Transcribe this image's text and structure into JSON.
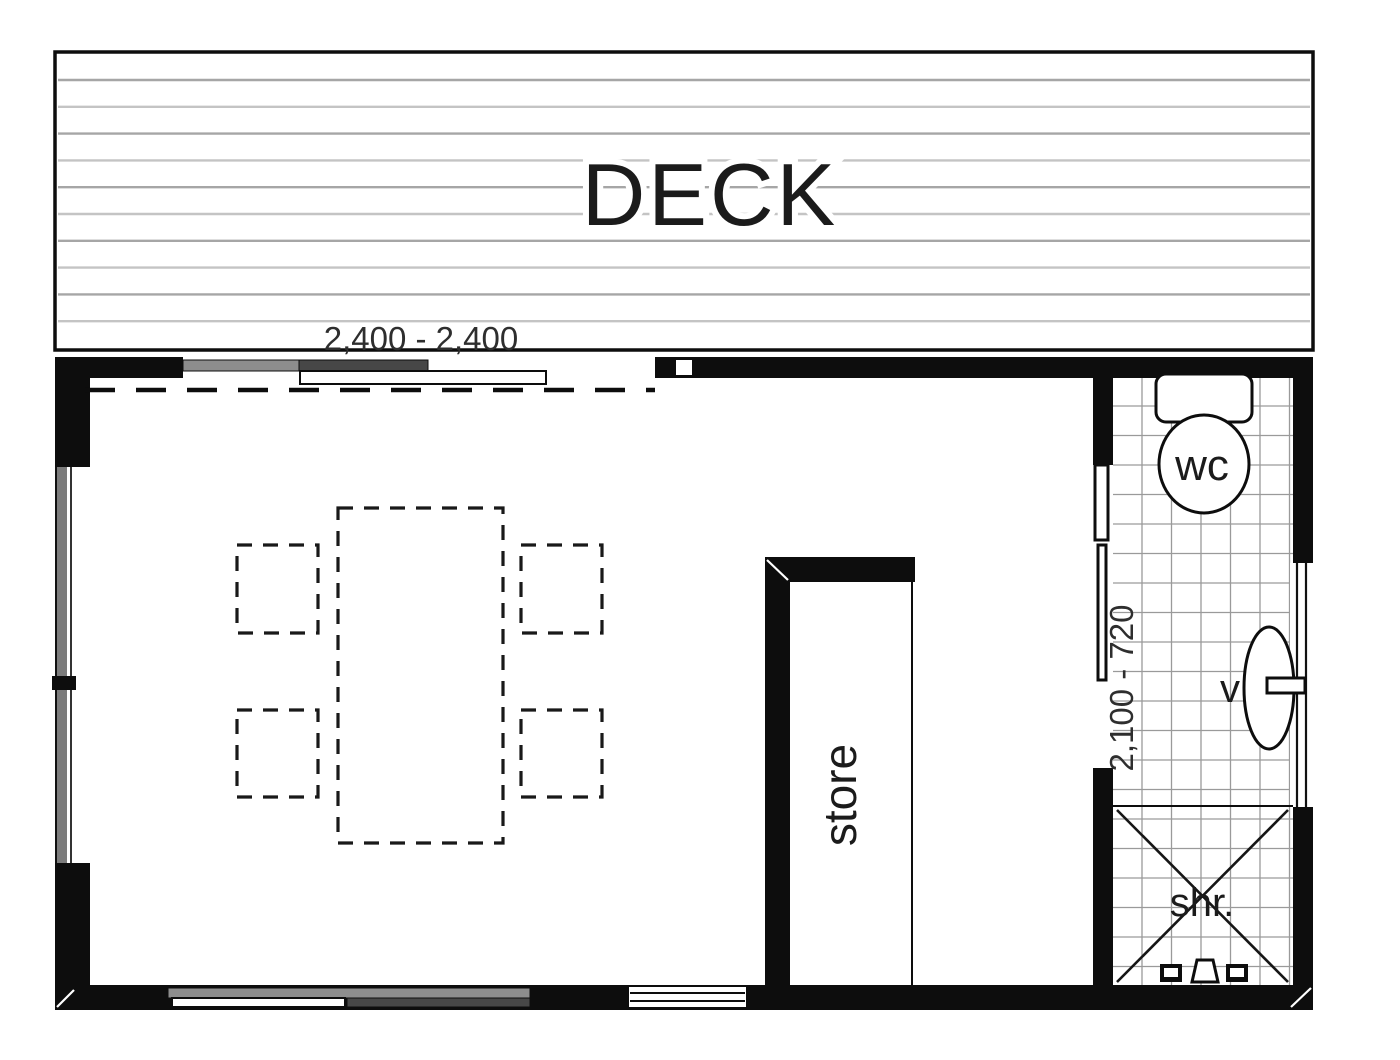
{
  "labels": {
    "deck": "DECK",
    "store": "store",
    "wc": "wc",
    "vanity": "v",
    "shower": "shr.",
    "top_dimension": "2,400 - 2,400",
    "side_dimension": "2,100 - 720"
  },
  "colors": {
    "background": "#ffffff",
    "wall": "#0d0d0d",
    "deck_board": "#a6a6a6",
    "tile": "#9a9a9a",
    "sash_light": "#8d8d8d",
    "sash_dark": "#474747",
    "text": "#1b1b1b",
    "dim_text": "#2e2e2e"
  }
}
